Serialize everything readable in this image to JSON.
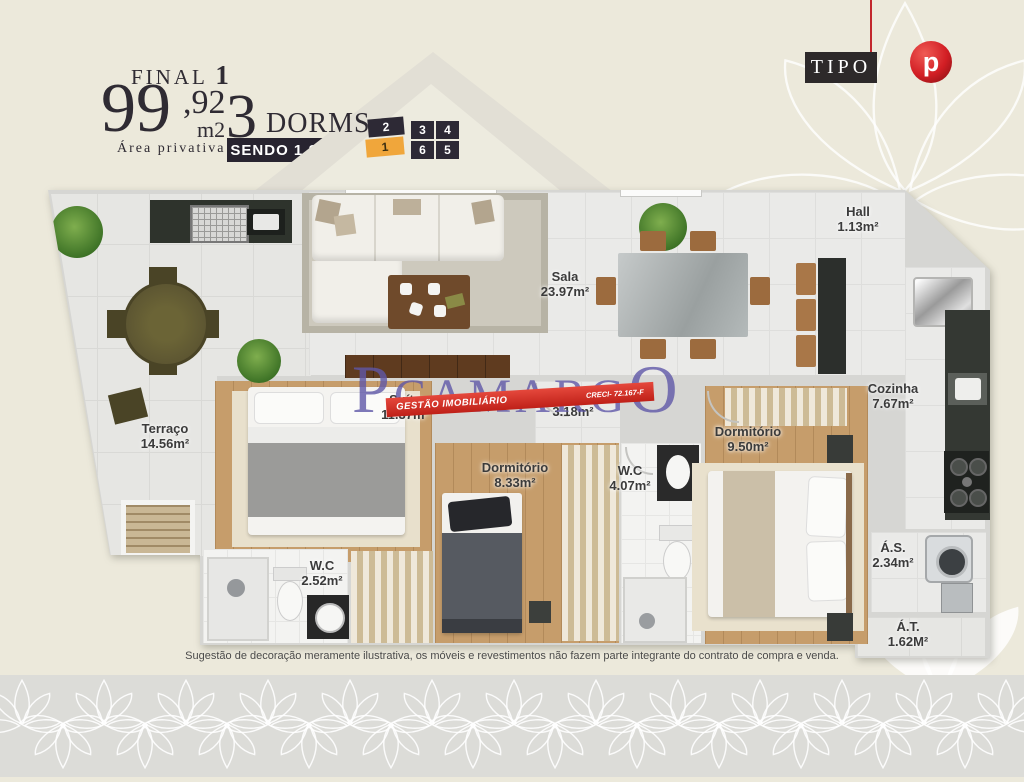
{
  "header": {
    "final_label": "FINAL",
    "final_number": "1",
    "area_int": "99",
    "area_dec": ",92",
    "area_unit": "m2",
    "area_caption": "Área privativa",
    "dorms_number": "3",
    "dorms_label": "DORMS.",
    "suite_badge": "SENDO 1 SUÍTE",
    "unit_map": {
      "cells": [
        {
          "label": "2",
          "highlighted": false
        },
        {
          "label": "1",
          "highlighted": true
        },
        {
          "label": "3",
          "highlighted": false
        },
        {
          "label": "4",
          "highlighted": false
        },
        {
          "label": "6",
          "highlighted": false
        },
        {
          "label": "5",
          "highlighted": false
        }
      ]
    }
  },
  "top_right": {
    "tipo_label": "TIPO",
    "logo_letter": "p"
  },
  "watermark": {
    "brand_p": "P",
    "brand_mid": "CAMARG",
    "brand_o": "O",
    "banner_left": "GESTÃO IMOBILIÁRIO",
    "banner_right": "CRECI- 72.167-F"
  },
  "rooms": [
    {
      "name": "Terraço",
      "area": "14.56m²"
    },
    {
      "name": "Sala",
      "area": "23.97m²"
    },
    {
      "name": "Hall",
      "area": "1.13m²"
    },
    {
      "name": "Cozinha",
      "area": "7.67m²"
    },
    {
      "name": "Suíte",
      "area": "11.37m²"
    },
    {
      "name": "Hall",
      "area": "3.18m²"
    },
    {
      "name": "Dormitório",
      "area": "8.33m²"
    },
    {
      "name": "W.C",
      "area": "4.07m²"
    },
    {
      "name": "Dormitório",
      "area": "9.50m²"
    },
    {
      "name": "W.C",
      "area": "2.52m²"
    },
    {
      "name": "Á.S.",
      "area": "2.34m²"
    },
    {
      "name": "Á.T.",
      "area": "1.62M²"
    }
  ],
  "disclaimer": "Sugestão de decoração meramente ilustrativa, os móveis e revestimentos não fazem parte integrante do contrato de compra e venda.",
  "colors": {
    "background": "#ECE9DB",
    "band": "#DCDCD8",
    "badge_dark": "#282430",
    "accent_orange": "#F0A63B",
    "logo_red": "#D21E24",
    "watermark_purple": "#5F58A8",
    "banner_red": "#D92C23"
  }
}
